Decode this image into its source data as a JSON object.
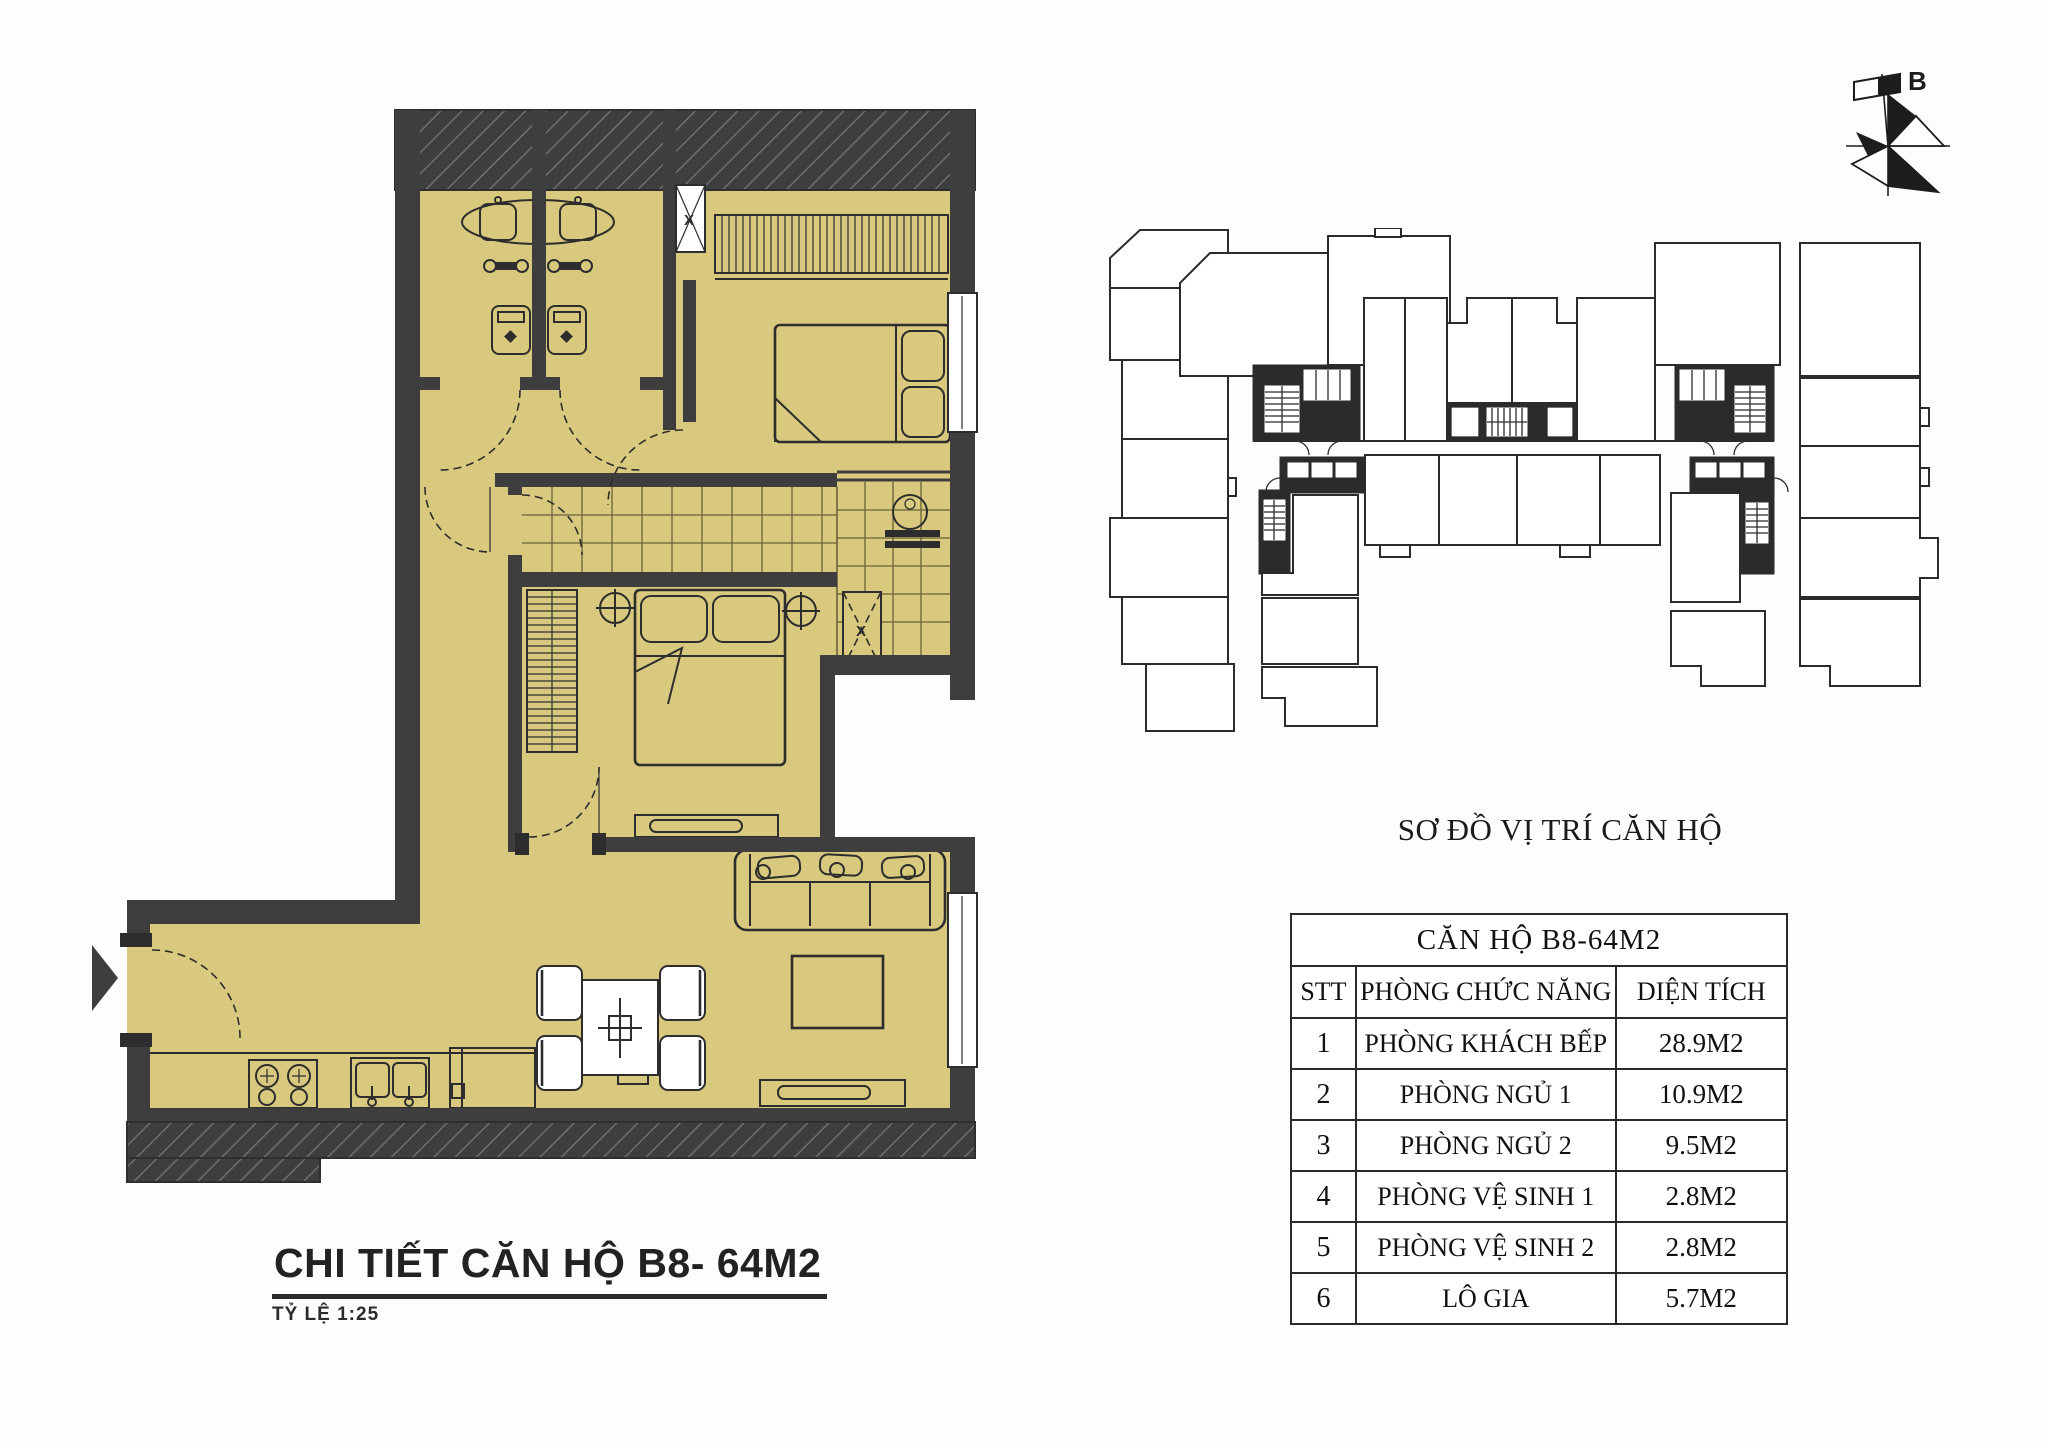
{
  "colors": {
    "floor": "#d8c97e",
    "wall": "#3e3e3e",
    "line": "#2d2d2d",
    "ovline": "#2b2b2b"
  },
  "detail_plan": {
    "title": "CHI TIẾT CĂN HỘ B8- 64M2",
    "scale_label": "TỶ LỆ  1:25",
    "shaft_label": "X"
  },
  "overview": {
    "title": "SƠ ĐỒ VỊ TRÍ CĂN HỘ",
    "compass_label": "B"
  },
  "table": {
    "title": "CĂN HỘ B8-64M2",
    "headers": [
      "STT",
      "PHÒNG CHỨC NĂNG",
      "DIỆN TÍCH"
    ],
    "rows": [
      [
        "1",
        "PHÒNG KHÁCH BẾP",
        "28.9M2"
      ],
      [
        "2",
        "PHÒNG NGỦ 1",
        "10.9M2"
      ],
      [
        "3",
        "PHÒNG NGỦ 2",
        "9.5M2"
      ],
      [
        "4",
        "PHÒNG VỆ SINH 1",
        "2.8M2"
      ],
      [
        "5",
        "PHÒNG VỆ SINH 2",
        "2.8M2"
      ],
      [
        "6",
        "LÔ GIA",
        "5.7M2"
      ]
    ]
  }
}
